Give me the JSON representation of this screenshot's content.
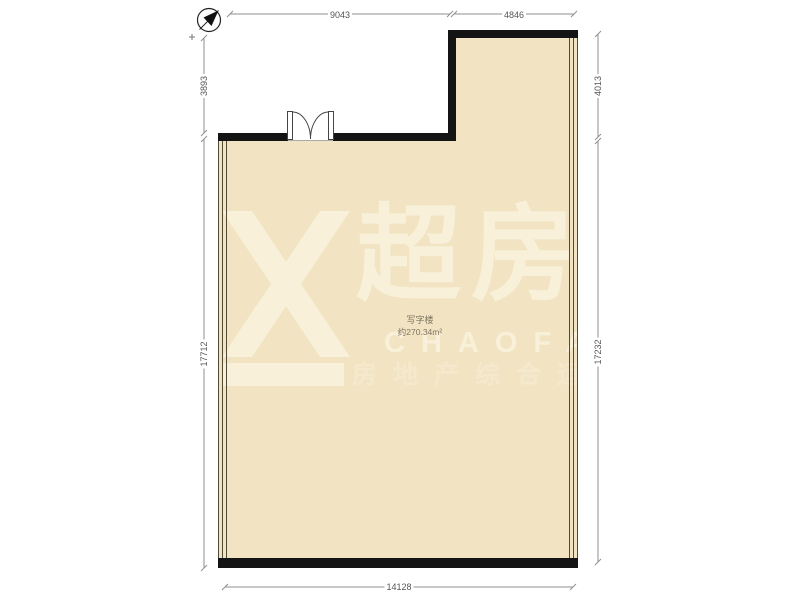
{
  "plan": {
    "room": {
      "label": "写字楼",
      "area": "约270.34m²",
      "fill_color": "#f2e4c3",
      "wall_color": "#141414"
    },
    "dimensions": {
      "top_left": "9043",
      "top_right": "4846",
      "left_upper": "3893",
      "left_lower": "17712",
      "right_upper": "4013",
      "right_lower": "17232",
      "bottom": "14128"
    },
    "compass": {
      "icon": "north-arrow"
    },
    "features": {
      "door": "double-swing-door",
      "left_wall": "window",
      "right_wall": "window"
    }
  },
  "watermark": {
    "logo": "chaofang-x-logo",
    "brand_cn": "超房",
    "brand_en": "CHAOFANG",
    "tagline": "房地产综合运营",
    "color": "#f8f0d9"
  }
}
